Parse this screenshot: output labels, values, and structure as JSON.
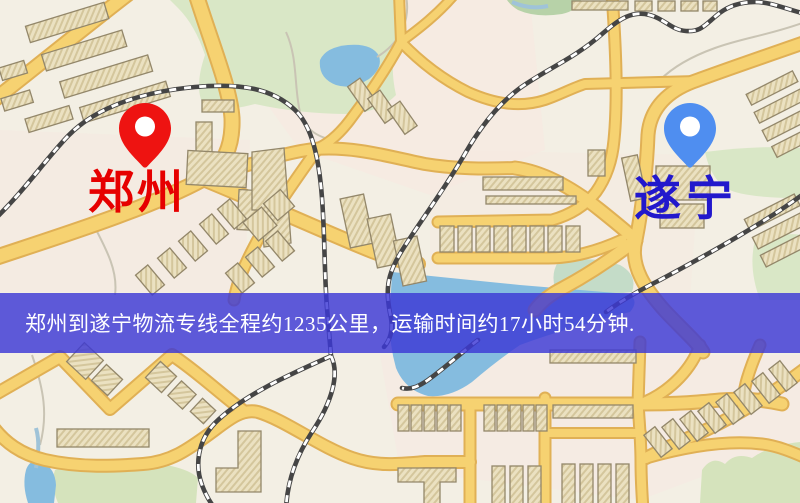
{
  "banner": {
    "text": "郑州到遂宁物流专线全程约1235公里，运输时间约17小时54分钟.",
    "background_color": "#3c38d6",
    "text_color": "#ffffff"
  },
  "markers": {
    "origin": {
      "city": "郑州",
      "pin_color": "#ee1311",
      "pin_hole_color": "#ffffff",
      "label_color": "#e60000"
    },
    "destination": {
      "city": "遂宁",
      "pin_color": "#4f8ef0",
      "pin_hole_color": "#ffffff",
      "label_color": "#2218cc"
    }
  },
  "map": {
    "palette": {
      "background": "#f3efe4",
      "residential_tint": "#f7e7e0",
      "park_green": "#d9e7c6",
      "field_green": "#d5e3bc",
      "water_blue": "#85bcdf",
      "road_yellow": "#f6d271",
      "road_casing": "#e0b055",
      "building_fill": "#ebe1c1",
      "building_outline": "#93876a",
      "railway_dark": "#454545",
      "railway_light": "#ffffff"
    }
  }
}
